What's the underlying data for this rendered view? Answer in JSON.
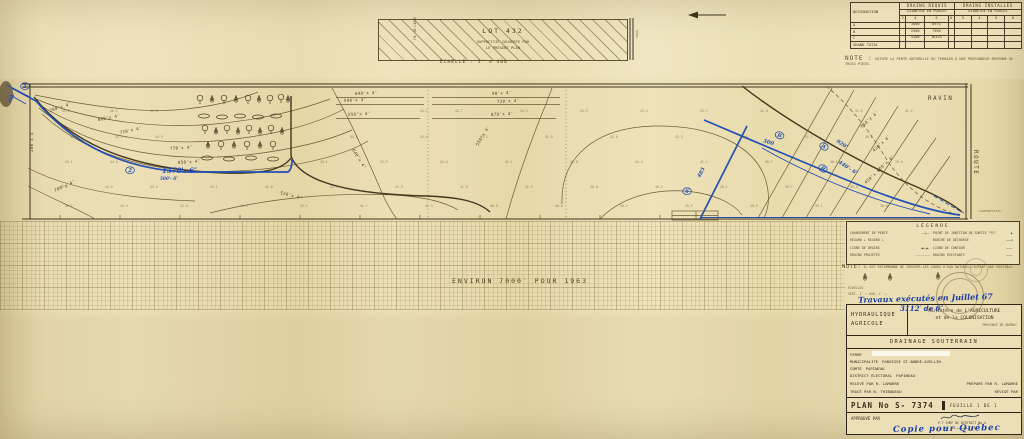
{
  "drains_table": {
    "designation_header": "DESIGNATION",
    "requis_header": "DRAINS REQUIS",
    "installes_header": "DRAINS INSTALLÉS",
    "diam_header": "DIAMÈTRE EN POUCES",
    "subcols": [
      "3",
      "4",
      "5",
      "6"
    ],
    "rows": [
      [
        "A",
        "",
        "1600",
        "8975",
        "",
        "",
        "",
        "",
        ""
      ],
      [
        "B",
        "",
        "2500",
        "7350",
        "",
        "",
        "",
        "",
        ""
      ],
      [
        "C",
        "",
        "4100",
        "16325",
        "",
        "",
        "",
        "",
        ""
      ],
      [
        "GRAND TOTAL",
        "",
        "",
        "",
        "",
        "",
        "",
        "",
        ""
      ]
    ]
  },
  "note_top": {
    "label": "NOTE :",
    "text": "SUIVRE LA PENTE NATURELLE DU TERRAIN À UNE PROFONDEUR MOYENNE DE TROIS PIEDS."
  },
  "lot_box": {
    "lot": "LOT  432",
    "line1": "SUPERFICIE COUVERTE PAR",
    "line2": "LE PRÉSENT PLAN",
    "left_vertical": "CH. DE LIGNE",
    "scale": "ÉCHELLE : 1″ = 400′"
  },
  "grid_note": "ENVIRON  7000′  POUR  1963",
  "legend": {
    "title": "LÉGENDE",
    "left": [
      {
        "label": "CHANGEMENT DE PENTE",
        "sym": "——|——"
      },
      {
        "label": "REGARD ⊥    REGARD ⊥",
        "sym": ""
      },
      {
        "label": "LIGNE DE DRAINS",
        "sym": "—▲——▲—"
      },
      {
        "label": "DRAINS PROJETÉS",
        "sym": "– – – – –"
      }
    ],
    "right": [
      {
        "label": "POINT DE JONCTION DE SORTIE \"PJ\"",
        "sym": "▲"
      },
      {
        "label": "BOUCHE DE DÉCHARGE",
        "sym": "———◄"
      },
      {
        "label": "LIGNE DE CONTOUR",
        "sym": "————"
      },
      {
        "label": "DRAINS EXISTANTS",
        "sym": "————"
      }
    ]
  },
  "note_legend": {
    "label": "NOTE:",
    "text": "IL EST RECOMMANDÉ DE CREUSER LES COURS D'EAU NATURELS AUTANT QUE POSSIBLE."
  },
  "echelles": {
    "l1": "ÉCHELLES",
    "l2": "VERT. 1″ =         HOR. 1″ ="
  },
  "title_block": {
    "hyd1": "HYDRAULIQUE",
    "hyd2": "AGRICOLE",
    "ministere1": "Ministère de L'AGRICULTURE",
    "ministere2": "et de la COLONISATION",
    "province": "PROVINCE DE QUÉBEC",
    "drainage": "DRAINAGE SOUTERRAIN",
    "fields": [
      {
        "l": "FERME",
        "v": "",
        "patch": 1
      },
      {
        "l": "MUNICIPALITÉ",
        "v": "PAROISSE  ST-ANDRÉ-AVELLIN"
      },
      {
        "l": "COMTÉ",
        "v": "PAPINEAU"
      },
      {
        "l": "DISTRICT ÉLECTORAL",
        "v": "PAPINEAU"
      }
    ],
    "duo": [
      [
        "RELEVÉ PAR  R. LAMARRE",
        "PRÉPARÉ PAR R. LAMARRE"
      ],
      [
        "TRACÉ PAR B. THIBODEAU",
        "RÉVISÉ PAR"
      ]
    ],
    "plan_label": "PLAN  No  S-  7374",
    "feuille": "FEUILLE   1   DE   1",
    "approuve": "APPROUVÉ PAR",
    "chef": "P.T  CHEF DE DISTRICT No 4",
    "date_line": "LE ………………………… 19……"
  },
  "handwriting": {
    "line1": "Travaux exécutés en Juillet 67",
    "line2": "3112′ de 6″",
    "copie": "Copie pour Québec"
  },
  "plan": {
    "labels": [
      {
        "t": "280'x 4″",
        "x": 50,
        "y": 112,
        "r": -18
      },
      {
        "t": "280'x 4″",
        "x": 33,
        "y": 152,
        "r": -90
      },
      {
        "t": "600'x 4″",
        "x": 98,
        "y": 121,
        "r": -10
      },
      {
        "t": "720'x 4″",
        "x": 120,
        "y": 134,
        "r": -12
      },
      {
        "t": "770'x 4″",
        "x": 170,
        "y": 150,
        "r": -4
      },
      {
        "t": "850'x 4″",
        "x": 178,
        "y": 164,
        "r": -4
      },
      {
        "t": "700'x 4″",
        "x": 55,
        "y": 192,
        "r": -25
      },
      {
        "t": "520'x 4″",
        "x": 280,
        "y": 194,
        "r": 14
      },
      {
        "t": "640'x 4″",
        "x": 355,
        "y": 95,
        "r": -3
      },
      {
        "t": "590'x 4″",
        "x": 344,
        "y": 102,
        "r": -3
      },
      {
        "t": "550'x 4″",
        "x": 348,
        "y": 116,
        "r": -3
      },
      {
        "t": "90'x 4″",
        "x": 492,
        "y": 95,
        "r": -3
      },
      {
        "t": "720'x 4″",
        "x": 497,
        "y": 103,
        "r": -3
      },
      {
        "t": "870'x 4″",
        "x": 491,
        "y": 116,
        "r": -3
      },
      {
        "t": "640'x 4″",
        "x": 352,
        "y": 150,
        "r": 58
      },
      {
        "t": "550'x 4″",
        "x": 478,
        "y": 146,
        "r": -58
      },
      {
        "t": "610'x 4″",
        "x": 862,
        "y": 128,
        "r": -42
      },
      {
        "t": "420'x 4″",
        "x": 874,
        "y": 152,
        "r": -42
      },
      {
        "t": "460'x 4″",
        "x": 878,
        "y": 172,
        "r": -42
      },
      {
        "t": "450'x 4″",
        "x": 866,
        "y": 184,
        "r": -42
      },
      {
        "t": "RAVIN",
        "x": 928,
        "y": 100,
        "cls": "big"
      },
      {
        "t": "ROUTE",
        "x": 974,
        "y": 150,
        "r": 90,
        "cls": "big"
      },
      {
        "t": "RANG",
        "x": 636,
        "y": 30,
        "r": 90,
        "cls": "tiny"
      },
      {
        "t": "(SUPERFICIE)",
        "x": 978,
        "y": 212,
        "cls": "tiny"
      }
    ],
    "blue_notes": [
      {
        "t": "1",
        "x": 25,
        "y": 88,
        "c": 1
      },
      {
        "t": "440'",
        "x": 10,
        "y": 103,
        "r": -55,
        "cls": "sm"
      },
      {
        "t": "2",
        "x": 130,
        "y": 172,
        "c": 1
      },
      {
        "t": "1370'- 6″",
        "x": 162,
        "y": 173,
        "cls": "lg"
      },
      {
        "t": "500'- 6″",
        "x": 160,
        "y": 180,
        "cls": "sm"
      },
      {
        "t": "6",
        "x": 687,
        "y": 193,
        "c": 1
      },
      {
        "t": "485",
        "x": 700,
        "y": 178,
        "r": -62
      },
      {
        "t": "500",
        "x": 763,
        "y": 142,
        "r": 18
      },
      {
        "t": "B",
        "x": 779,
        "y": 137,
        "r": 18,
        "c": 1
      },
      {
        "t": "920'",
        "x": 836,
        "y": 142,
        "r": 33
      },
      {
        "t": "A",
        "x": 823,
        "y": 148,
        "r": 33,
        "c": 1
      },
      {
        "t": "440'- 6″",
        "x": 838,
        "y": 163,
        "r": 33
      },
      {
        "t": "B",
        "x": 822,
        "y": 170,
        "r": 33,
        "c": 1
      }
    ],
    "spots": [
      [
        62,
        112,
        "45.2"
      ],
      [
        110,
        112,
        "46.1"
      ],
      [
        150,
        112,
        "45.8"
      ],
      [
        420,
        112,
        "44.1"
      ],
      [
        455,
        112,
        "44.7"
      ],
      [
        520,
        112,
        "44.3"
      ],
      [
        580,
        112,
        "43.9"
      ],
      [
        640,
        112,
        "43.4"
      ],
      [
        700,
        112,
        "43.1"
      ],
      [
        760,
        112,
        "42.8"
      ],
      [
        855,
        112,
        "41.9"
      ],
      [
        905,
        112,
        "41.2"
      ],
      [
        70,
        138,
        "44.8"
      ],
      [
        115,
        138,
        "45.1"
      ],
      [
        155,
        138,
        "44.9"
      ],
      [
        350,
        138,
        "43.8"
      ],
      [
        420,
        138,
        "43.6"
      ],
      [
        480,
        138,
        "43.2"
      ],
      [
        545,
        138,
        "42.9"
      ],
      [
        610,
        138,
        "42.6"
      ],
      [
        675,
        138,
        "42.2"
      ],
      [
        740,
        138,
        "41.8"
      ],
      [
        805,
        138,
        "41.1"
      ],
      [
        865,
        138,
        "40.6"
      ],
      [
        65,
        163,
        "44.1"
      ],
      [
        110,
        163,
        "44.6"
      ],
      [
        320,
        163,
        "43.1"
      ],
      [
        380,
        163,
        "42.9"
      ],
      [
        440,
        163,
        "42.4"
      ],
      [
        505,
        163,
        "42.1"
      ],
      [
        570,
        163,
        "41.8"
      ],
      [
        635,
        163,
        "41.4"
      ],
      [
        700,
        163,
        "41.1"
      ],
      [
        765,
        163,
        "40.7"
      ],
      [
        830,
        163,
        "40.2"
      ],
      [
        895,
        163,
        "39.8"
      ],
      [
        60,
        188,
        "43.6"
      ],
      [
        105,
        188,
        "43.9"
      ],
      [
        150,
        188,
        "43.4"
      ],
      [
        210,
        188,
        "43.1"
      ],
      [
        265,
        188,
        "42.8"
      ],
      [
        330,
        188,
        "42.3"
      ],
      [
        395,
        188,
        "41.9"
      ],
      [
        460,
        188,
        "41.6"
      ],
      [
        525,
        188,
        "41.2"
      ],
      [
        590,
        188,
        "40.8"
      ],
      [
        655,
        188,
        "40.4"
      ],
      [
        720,
        188,
        "40.1"
      ],
      [
        785,
        188,
        "39.7"
      ],
      [
        850,
        188,
        "39.3"
      ],
      [
        65,
        207,
        "43.1"
      ],
      [
        120,
        207,
        "43.3"
      ],
      [
        180,
        207,
        "42.9"
      ],
      [
        240,
        207,
        "42.5"
      ],
      [
        300,
        207,
        "42.1"
      ],
      [
        360,
        207,
        "41.7"
      ],
      [
        425,
        207,
        "41.3"
      ],
      [
        490,
        207,
        "40.9"
      ],
      [
        555,
        207,
        "40.6"
      ],
      [
        620,
        207,
        "40.2"
      ],
      [
        685,
        207,
        "39.9"
      ],
      [
        750,
        207,
        "39.5"
      ],
      [
        815,
        207,
        "39.1"
      ],
      [
        880,
        207,
        "38.8"
      ]
    ],
    "trees": [
      [
        200,
        101,
        "d"
      ],
      [
        212,
        100,
        "c"
      ],
      [
        224,
        101,
        "d"
      ],
      [
        236,
        100,
        "c"
      ],
      [
        248,
        101,
        "d"
      ],
      [
        259,
        100,
        "c"
      ],
      [
        270,
        101,
        "d"
      ],
      [
        281,
        100,
        "d"
      ],
      [
        288,
        100,
        "c"
      ],
      [
        204,
        116,
        "b"
      ],
      [
        222,
        117,
        "b"
      ],
      [
        240,
        116,
        "b"
      ],
      [
        258,
        117,
        "b"
      ],
      [
        276,
        116,
        "b"
      ],
      [
        205,
        131,
        "d"
      ],
      [
        216,
        132,
        "c"
      ],
      [
        227,
        131,
        "d"
      ],
      [
        238,
        132,
        "c"
      ],
      [
        249,
        131,
        "d"
      ],
      [
        260,
        132,
        "c"
      ],
      [
        271,
        131,
        "d"
      ],
      [
        282,
        132,
        "c"
      ],
      [
        208,
        146,
        "c"
      ],
      [
        221,
        147,
        "d"
      ],
      [
        234,
        146,
        "c"
      ],
      [
        247,
        147,
        "d"
      ],
      [
        260,
        146,
        "c"
      ],
      [
        273,
        147,
        "d"
      ],
      [
        207,
        158,
        "b"
      ],
      [
        229,
        159,
        "b"
      ],
      [
        251,
        158,
        "b"
      ],
      [
        273,
        159,
        "b"
      ],
      [
        865,
        278,
        "c"
      ],
      [
        890,
        278,
        "c"
      ],
      [
        938,
        277,
        "c"
      ]
    ]
  }
}
